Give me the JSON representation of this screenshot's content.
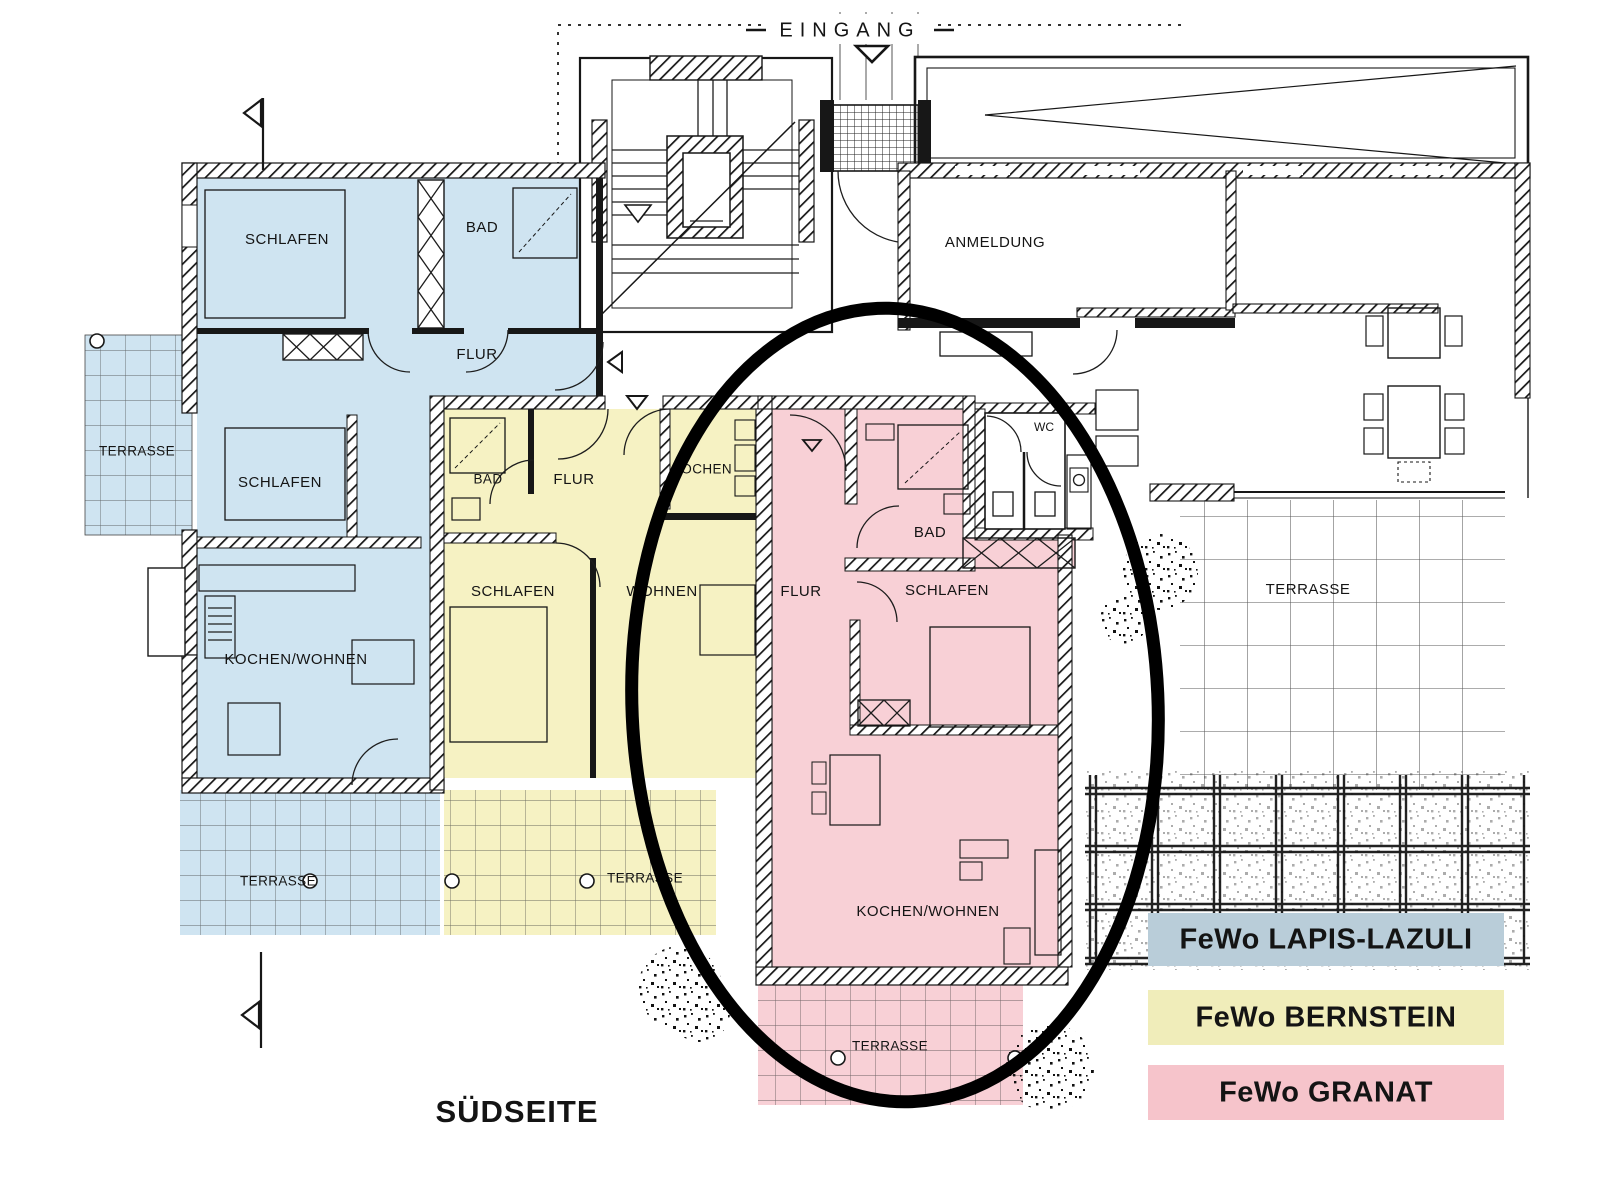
{
  "site": {
    "eingang": "EINGANG",
    "anmeldung": "ANMELDUNG",
    "wc": "WC",
    "suedseite": "SÜDSEITE",
    "terrasse_ost": "TERRASSE"
  },
  "apartments": {
    "lapis_lazuli": {
      "legend_label": "FeWo LAPIS-LAZULI",
      "fill": "#cfe4f1",
      "legend_fill": "#b9cdd9",
      "rooms": {
        "schlafen_1": "SCHLAFEN",
        "bad": "BAD",
        "flur": "FLUR",
        "schlafen_2": "SCHLAFEN",
        "kochen_wohnen": "KOCHEN/WOHNEN",
        "terrasse_west": "TERRASSE",
        "terrasse_sued": "TERRASSE"
      }
    },
    "bernstein": {
      "legend_label": "FeWo BERNSTEIN",
      "fill": "#f6f2c3",
      "legend_fill": "#f0edba",
      "rooms": {
        "bad": "BAD",
        "flur": "FLUR",
        "kochen": "KOCHEN",
        "schlafen": "SCHLAFEN",
        "wohnen": "WOHNEN",
        "terrasse": "TERRASSE"
      }
    },
    "granat": {
      "legend_label": "FeWo GRANAT",
      "fill": "#f8d0d6",
      "legend_fill": "#f6c4cb",
      "rooms": {
        "flur": "FLUR",
        "bad": "BAD",
        "schlafen": "SCHLAFEN",
        "kochen_wohnen": "KOCHEN/WOHNEN",
        "terrasse": "TERRASSE"
      }
    }
  },
  "annotation": {
    "ellipse_color": "#000000"
  }
}
